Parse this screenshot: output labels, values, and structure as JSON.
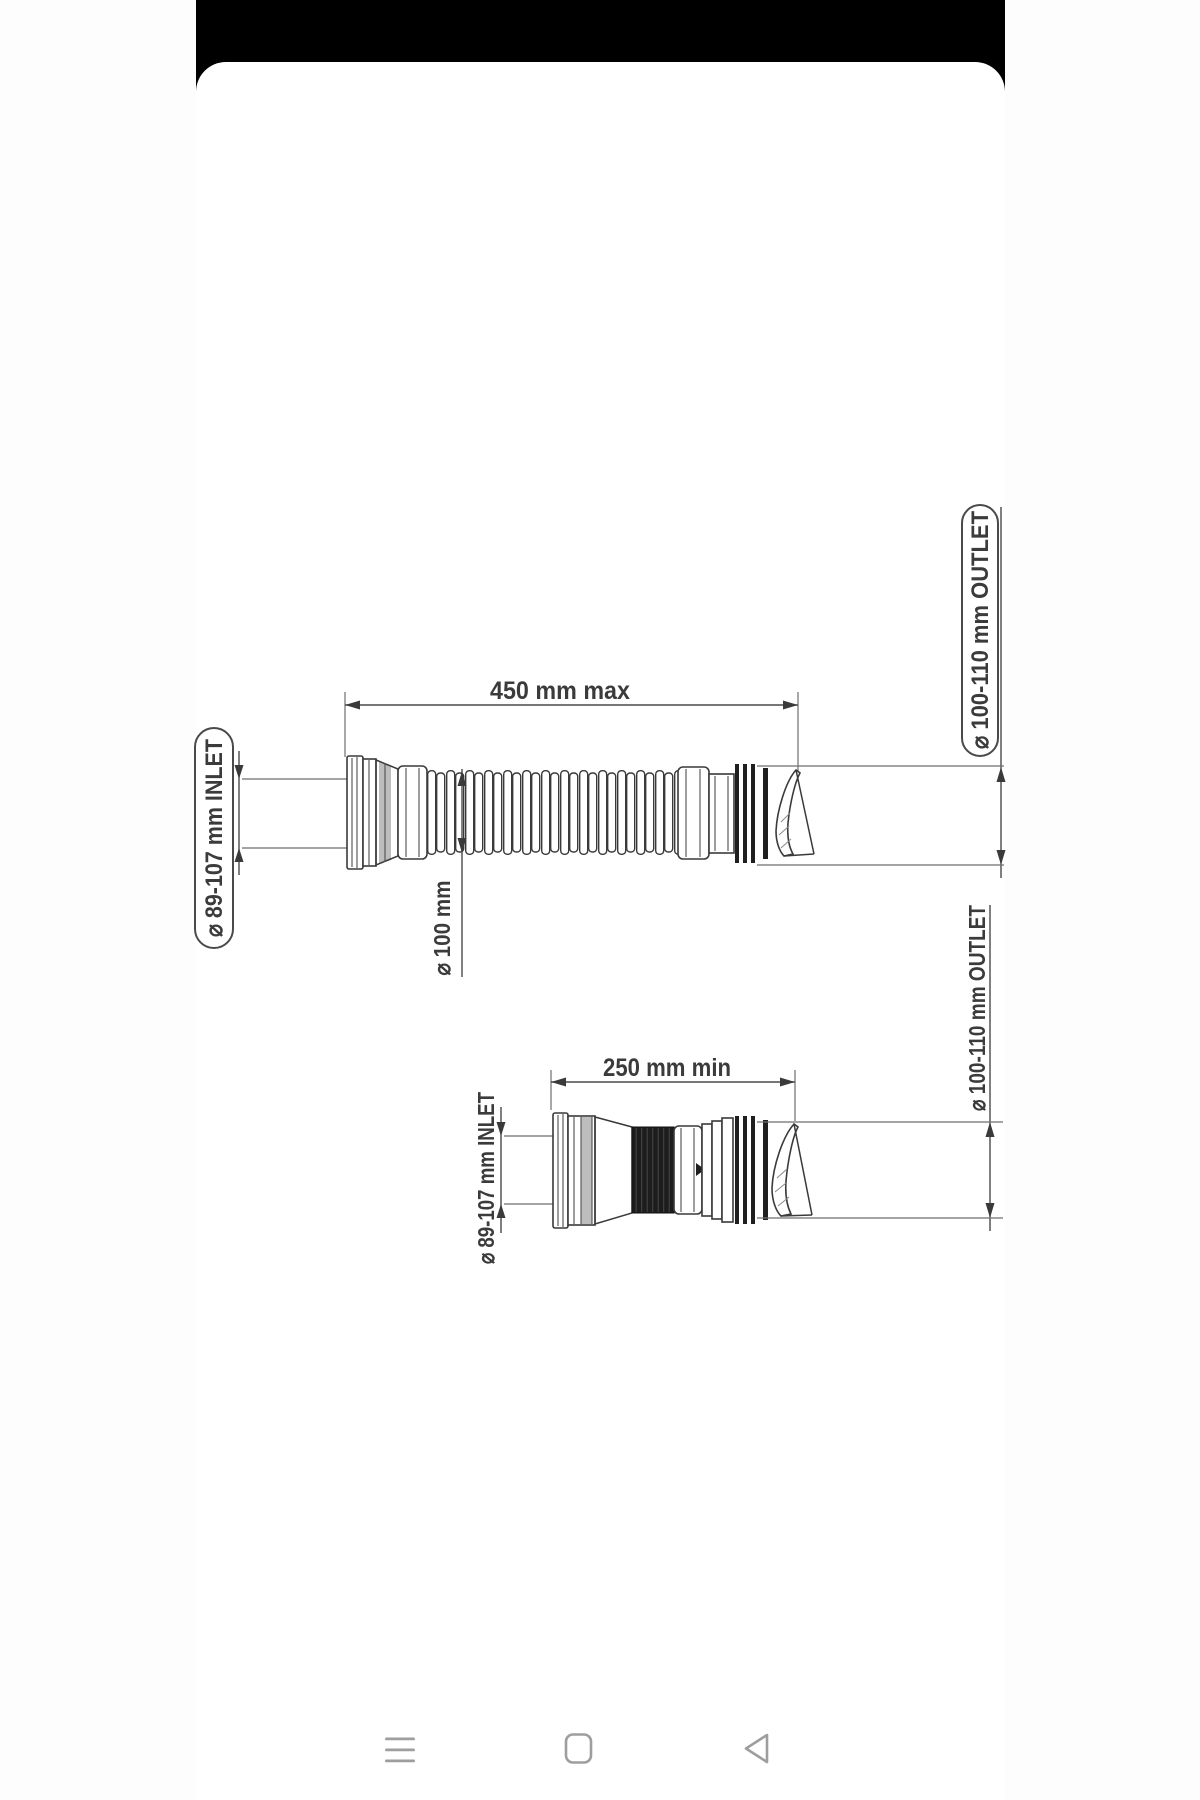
{
  "colors": {
    "statusbar": "#000000",
    "card_bg": "#ffffff",
    "drawing_line": "#3a3a3a",
    "fin_dark": "#1f1f1f",
    "shade_gray": "#bdbdbd",
    "nav_icon": "#9e9e9e"
  },
  "top_view": {
    "length_label": "450  mm max",
    "inlet_label": "⌀ 89-107 mm INLET",
    "tube_diameter_label": "⌀ 100 mm",
    "outlet_label": "⌀ 100-110 mm OUTLET"
  },
  "bottom_view": {
    "length_label": "250 mm min",
    "inlet_label": "⌀ 89-107 mm INLET",
    "outlet_label": "⌀ 100-110 mm OUTLET"
  },
  "nav_bar": {
    "menu_icon": "hamburger-menu",
    "home_icon": "home-square",
    "back_icon": "back-triangle"
  }
}
